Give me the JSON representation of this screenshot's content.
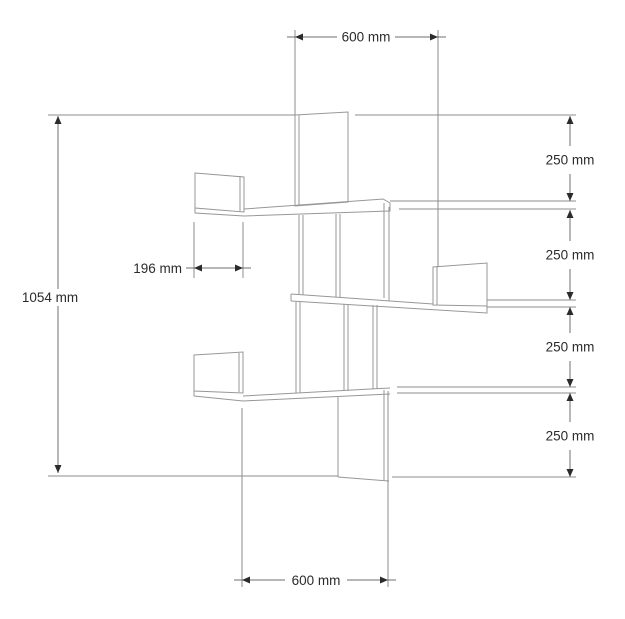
{
  "drawing": {
    "dimensions": {
      "top_width": "600 mm",
      "bottom_width": "600 mm",
      "overall_height": "1054 mm",
      "shelf_depth": "196 mm",
      "spacing_1": "250 mm",
      "spacing_2": "250 mm",
      "spacing_3": "250 mm",
      "spacing_4": "250 mm"
    },
    "values": {
      "top_width_mm": 600,
      "bottom_width_mm": 600,
      "overall_height_mm": 1054,
      "shelf_depth_mm": 196,
      "shelf_spacing_mm": [
        250,
        250,
        250,
        250
      ]
    }
  }
}
